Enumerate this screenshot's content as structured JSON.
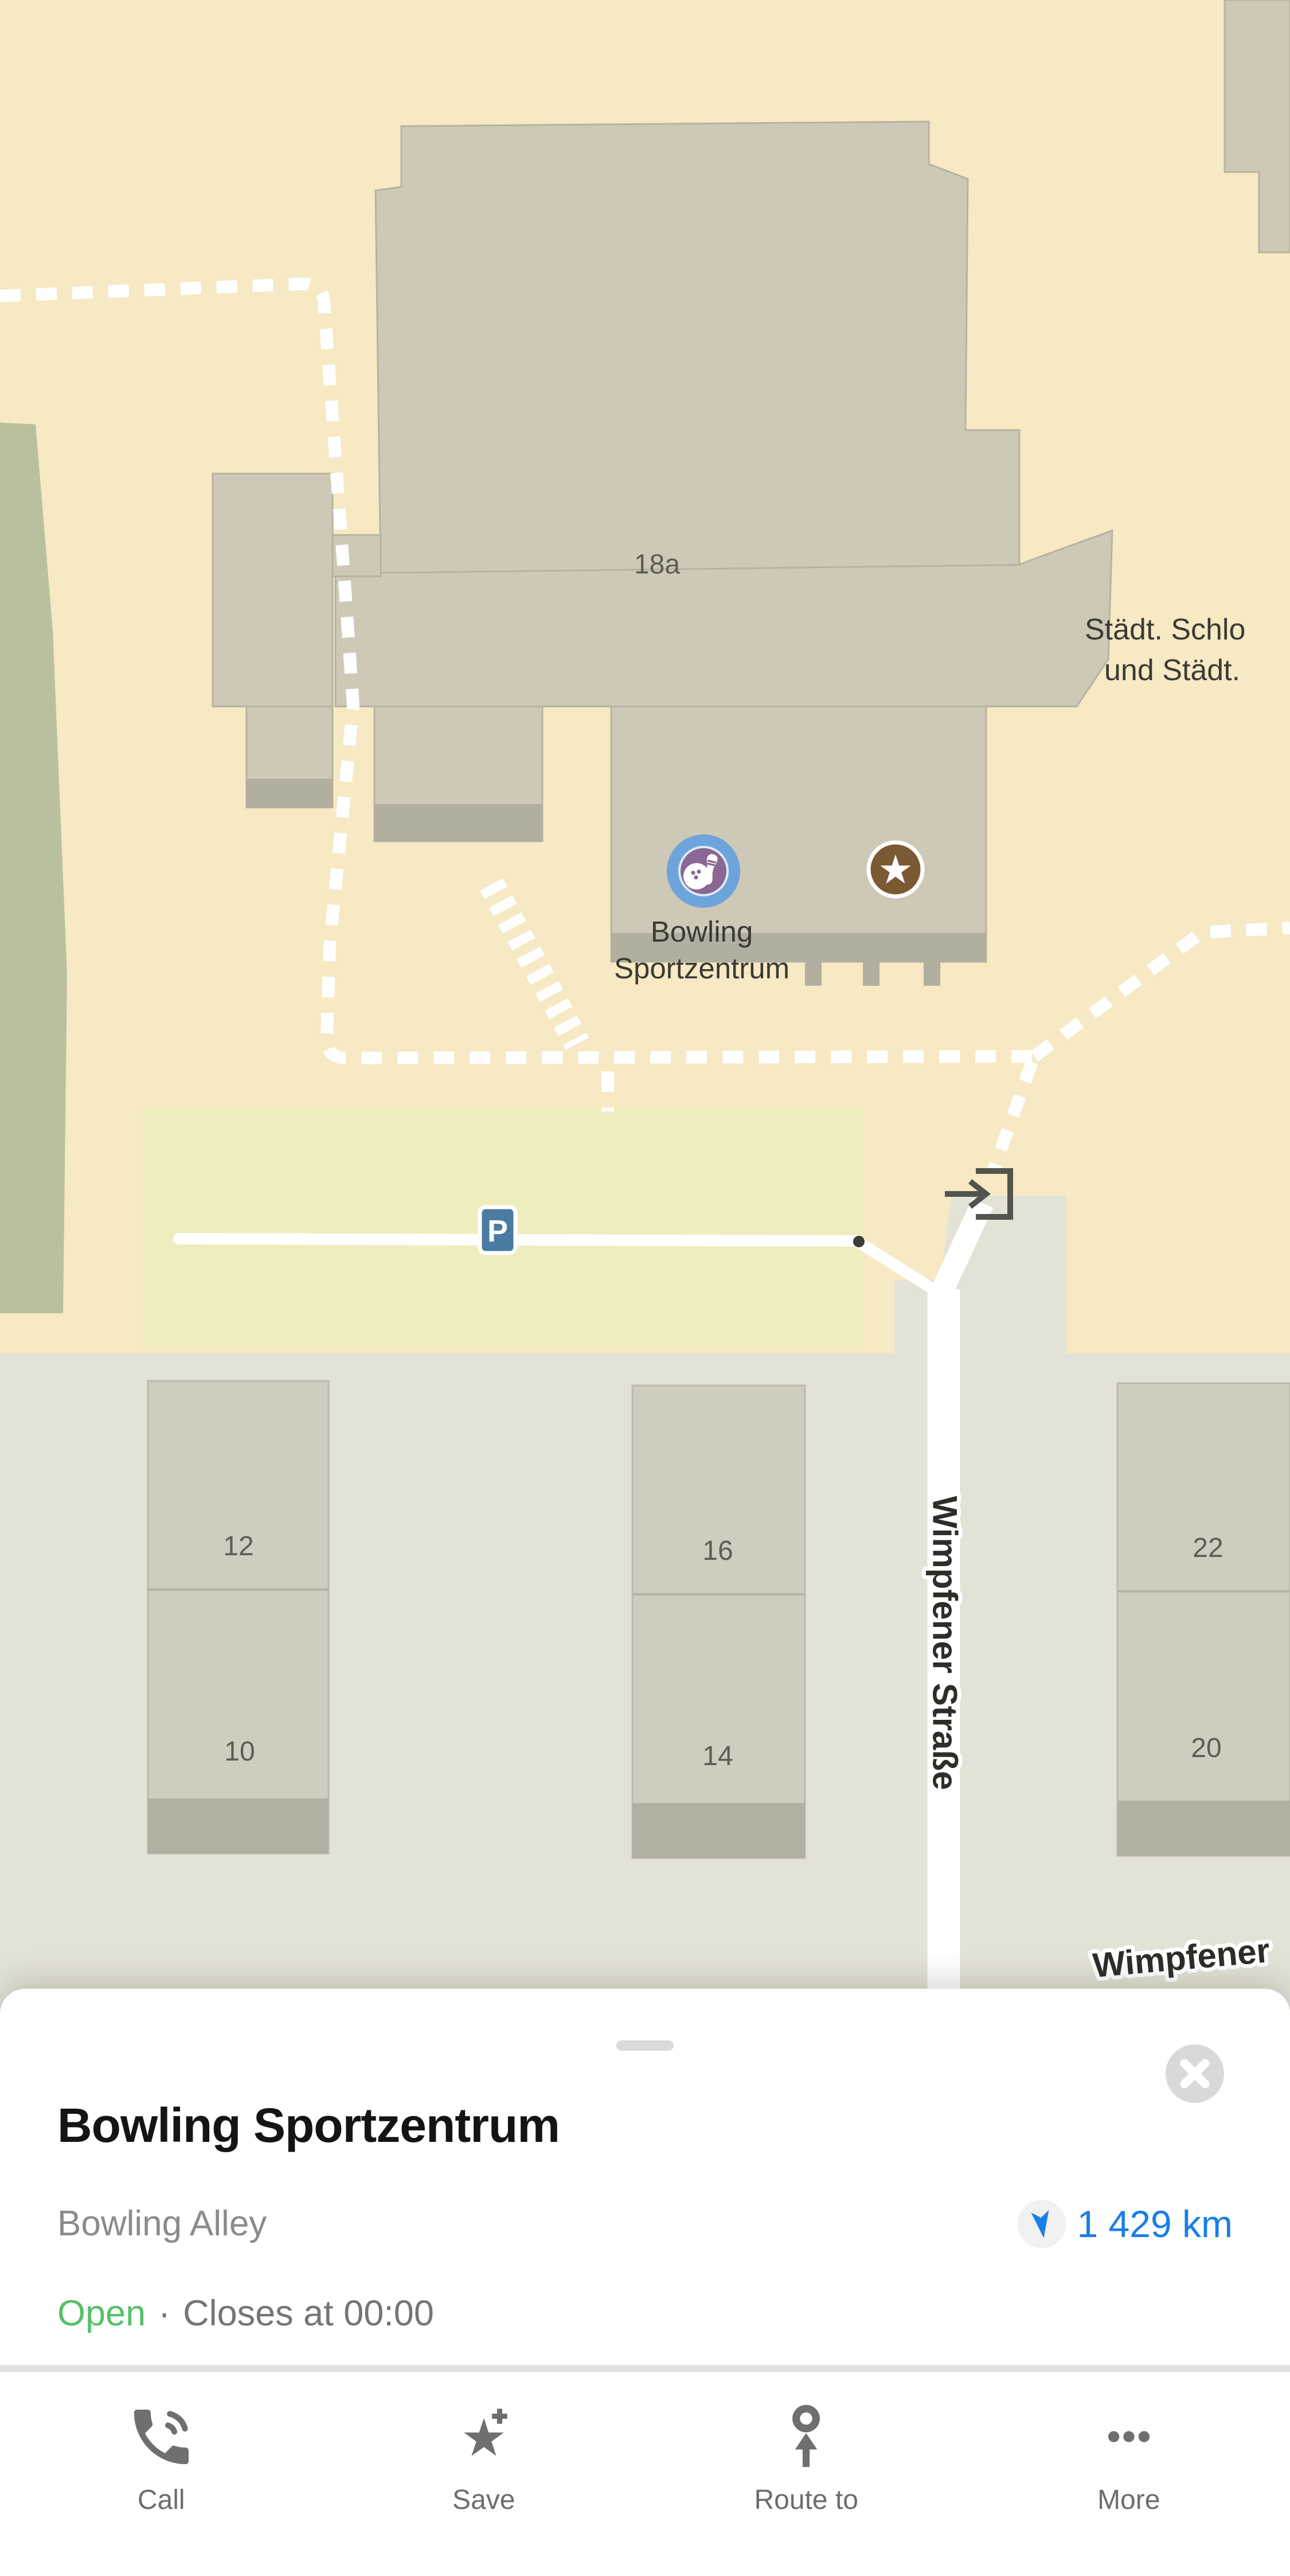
{
  "map": {
    "labels": {
      "building_number": "18a",
      "area_line1": "Städt. Schlo",
      "area_line2": "und Städt.",
      "poi_line1": "Bowling",
      "poi_line2": "Sportzentrum",
      "street_vertical": "Wimpfener Straße",
      "street_bottom": "Wimpfener",
      "parking": "P",
      "house_numbers": [
        "12",
        "10",
        "16",
        "14",
        "22",
        "20"
      ]
    },
    "colors": {
      "background_beige": "#f6e9c3",
      "lower_gray": "#e3e2d6",
      "building_fill": "#cec9b6",
      "parking_area": "#efedbd",
      "green_area": "#b9c09e",
      "poi_bowling_blue": "#6ea4dc",
      "poi_bowling_purple": "#8a6794",
      "poi_star_brown": "#7b5a33",
      "parking_sign_blue": "#4a7ba3"
    }
  },
  "sheet": {
    "title": "Bowling Sportzentrum",
    "category": "Bowling Alley",
    "distance": "1 429 km",
    "status_open": "Open",
    "separator": "·",
    "hours": "Closes at 00:00",
    "actions": [
      "Call",
      "Save",
      "Route to",
      "More"
    ],
    "colors": {
      "distance_blue": "#1a7ee6",
      "open_green": "#57c06a"
    }
  }
}
